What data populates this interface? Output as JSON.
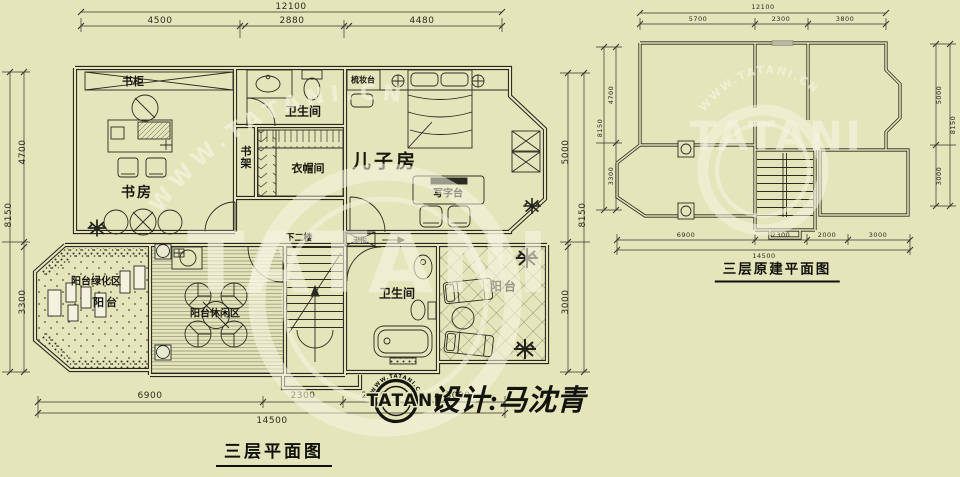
{
  "brand": {
    "name": "TATANI",
    "site": "WWW.TATANI.CN"
  },
  "signature": {
    "designer": "设计:马沈青"
  },
  "colors": {
    "background": "#e4e5ba",
    "line": "#26261d",
    "watermark": "#f7f5e2"
  },
  "left_plan": {
    "title": "三层平面图",
    "dim_top_total": "12100",
    "dim_top_segments": [
      "4500",
      "2880",
      "4480"
    ],
    "dim_left_total": "8150",
    "dim_left_segments": [
      "4700",
      "3300"
    ],
    "dim_right_total": "8150",
    "dim_right_segments": [
      "5000",
      "3000"
    ],
    "dim_bottom_total": "14500",
    "dim_bottom_segments": [
      "6900",
      "2300",
      "2000",
      "3000"
    ],
    "labels": {
      "bookcase": "书柜",
      "study": "书房",
      "bath_upper": "卫生间",
      "bookshelf": "书架",
      "cloakroom": "衣帽间",
      "dressing_table": "梳妆台",
      "sons_room": "儿子房",
      "writing_desk": "写字台",
      "down_stairs": "下二楼",
      "bookcase_small": "书柜",
      "bath_lower": "卫生间",
      "balcony_right": "阳台",
      "balcony_green": "阳台绿化区",
      "balcony_small": "阳台",
      "balcony_leisure": "阳台休闲区"
    }
  },
  "right_plan": {
    "title": "三层原建平面图",
    "dim_top_total": "12100",
    "dim_top_segments": [
      "5700",
      "2300",
      "3800"
    ],
    "dim_left_total": "8150",
    "dim_left_segments": [
      "4700",
      "3300"
    ],
    "dim_right_total": "8150",
    "dim_right_segments": [
      "5000",
      "3000"
    ],
    "dim_bottom_total": "14500",
    "dim_bottom_segments": [
      "6900",
      "2300",
      "2000",
      "3000"
    ]
  }
}
